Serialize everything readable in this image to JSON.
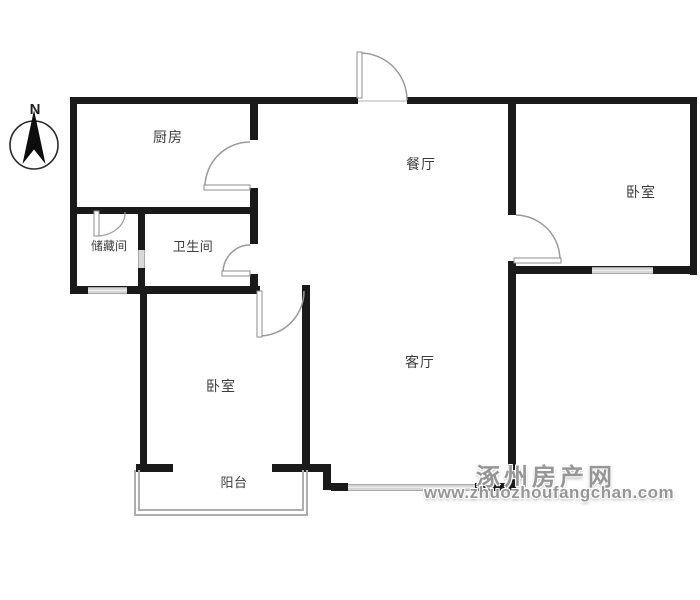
{
  "compass": {
    "north_label": "N"
  },
  "rooms": {
    "kitchen": {
      "label": "厨房"
    },
    "dining": {
      "label": "餐厅"
    },
    "bedroom_right": {
      "label": "卧室"
    },
    "storage": {
      "label": "储藏间"
    },
    "bathroom": {
      "label": "卫生间"
    },
    "living": {
      "label": "客厅"
    },
    "bedroom_left": {
      "label": "卧室"
    },
    "balcony": {
      "label": "阳台"
    }
  },
  "watermark": {
    "site_name": "涿州房产网",
    "website": "www.zhuozhoufangchan.com"
  },
  "colors": {
    "bg": "#ffffff",
    "wall": "#1a1a1a",
    "label": "#3c3c3c",
    "door": "#9a9a9a",
    "balcony": "#aeaeae",
    "watermark": "#969696"
  }
}
